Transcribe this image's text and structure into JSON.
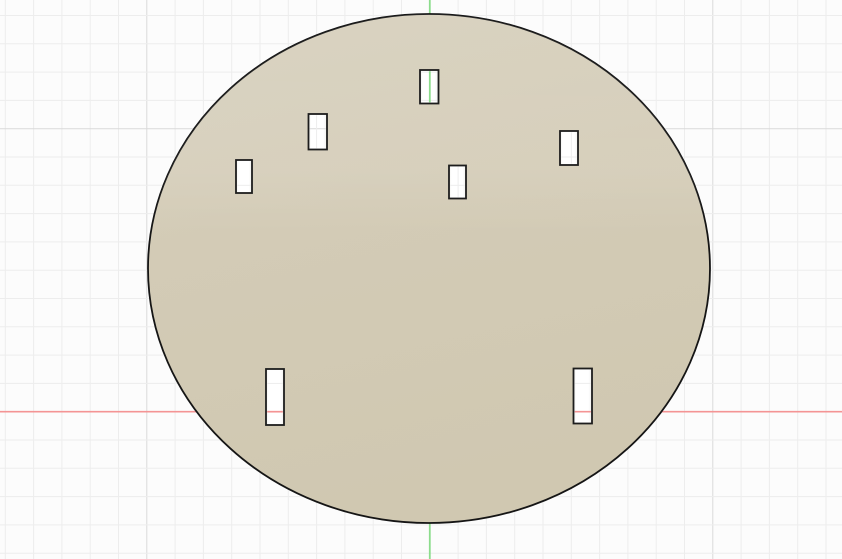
{
  "viewport": {
    "description": "CAD modeling viewport showing a circular plate body with seven rectangular slot holes on a sketch grid",
    "canvas": {
      "width": 842,
      "height": 559,
      "background": "#fcfcfc"
    },
    "grid": {
      "origin_x": 429.8,
      "origin_y": 411.7,
      "minor_step": 28.3,
      "major_every": 10,
      "minor_color": "#ededed",
      "major_color": "#d9d9d9"
    },
    "axes": {
      "x_axis": {
        "y": 411.7,
        "color": "#f49494",
        "width": 1.7
      },
      "y_axis": {
        "x": 429.8,
        "color": "#8cdc8c",
        "width": 1.8
      }
    },
    "plate": {
      "cx": 429,
      "cy": 268.5,
      "rx": 281,
      "ry": 254.5,
      "fill": "#d3cbb6",
      "fill_top": "#d7d0bd",
      "fill_bottom": "#d0c8b1",
      "stroke": "#151515",
      "stroke_width": 1.8
    },
    "hole_style": {
      "fill_center": "#ffffff",
      "fill_edge": "#f1f1ee",
      "stroke": "#1d1d1d",
      "stroke_width": 1.8
    },
    "holes": [
      {
        "id": "hole-top-center",
        "x": 420,
        "y": 70,
        "w": 18.5,
        "h": 33.5
      },
      {
        "id": "hole-upper-left",
        "x": 308.5,
        "y": 114,
        "w": 18.5,
        "h": 35.5
      },
      {
        "id": "hole-left",
        "x": 236,
        "y": 160,
        "w": 16,
        "h": 33
      },
      {
        "id": "hole-center",
        "x": 449,
        "y": 165.5,
        "w": 17,
        "h": 33
      },
      {
        "id": "hole-right",
        "x": 560,
        "y": 131,
        "w": 18,
        "h": 34
      },
      {
        "id": "hole-bottom-left",
        "x": 266,
        "y": 369,
        "w": 18,
        "h": 56
      },
      {
        "id": "hole-bottom-right",
        "x": 573.5,
        "y": 368.5,
        "w": 18.5,
        "h": 55
      }
    ]
  }
}
